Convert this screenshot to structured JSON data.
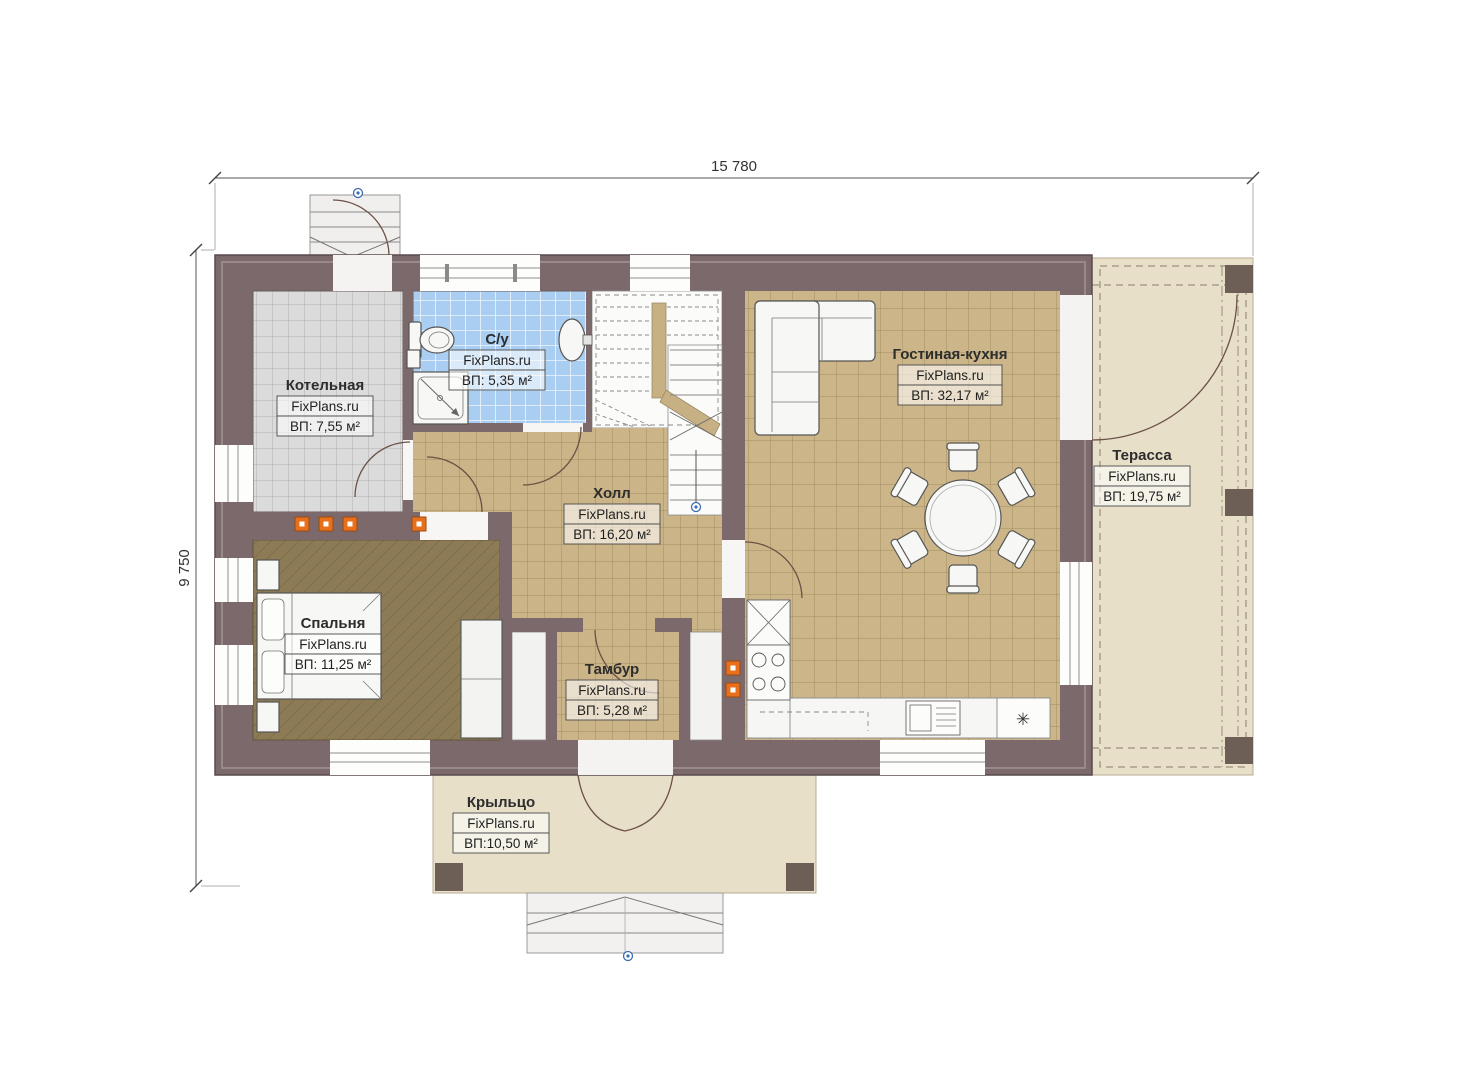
{
  "plan": {
    "type": "floor-plan",
    "source_watermark": "FixPlans.ru"
  },
  "dimensions": {
    "width_total": "15 780",
    "height_total": "9 750"
  },
  "rooms": {
    "boiler": {
      "name": "Котельная",
      "site": "FixPlans.ru",
      "area": "ВП: 7,55 м²"
    },
    "bathroom": {
      "name": "С/у",
      "site": "FixPlans.ru",
      "area": "ВП: 5,35 м²"
    },
    "hall": {
      "name": "Холл",
      "site": "FixPlans.ru",
      "area": "ВП: 16,20 м²"
    },
    "living": {
      "name": "Гостиная-кухня",
      "site": "FixPlans.ru",
      "area": "ВП: 32,17 м²"
    },
    "terrace": {
      "name": "Терасса",
      "site": "FixPlans.ru",
      "area": "ВП: 19,75 м²"
    },
    "bedroom": {
      "name": "Спальня",
      "site": "FixPlans.ru",
      "area": "ВП: 11,25 м²"
    },
    "vestibule": {
      "name": "Тамбур",
      "site": "FixPlans.ru",
      "area": "ВП: 5,28 м²"
    },
    "porch": {
      "name": "Крыльцо",
      "site": "FixPlans.ru",
      "area": "ВП:10,50 м²"
    }
  },
  "symbols": {
    "fridge": "✳"
  },
  "colors": {
    "wall": "#7b696b",
    "tile_tan": "#ccb689",
    "tile_gray": "#dbdbdb",
    "tile_blue": "#a9cef1",
    "wood_floor": "#8c7b55",
    "terrace_floor": "#e8dfc9",
    "accent_orange": "#e8701d",
    "marker_blue": "#3b6db0"
  }
}
